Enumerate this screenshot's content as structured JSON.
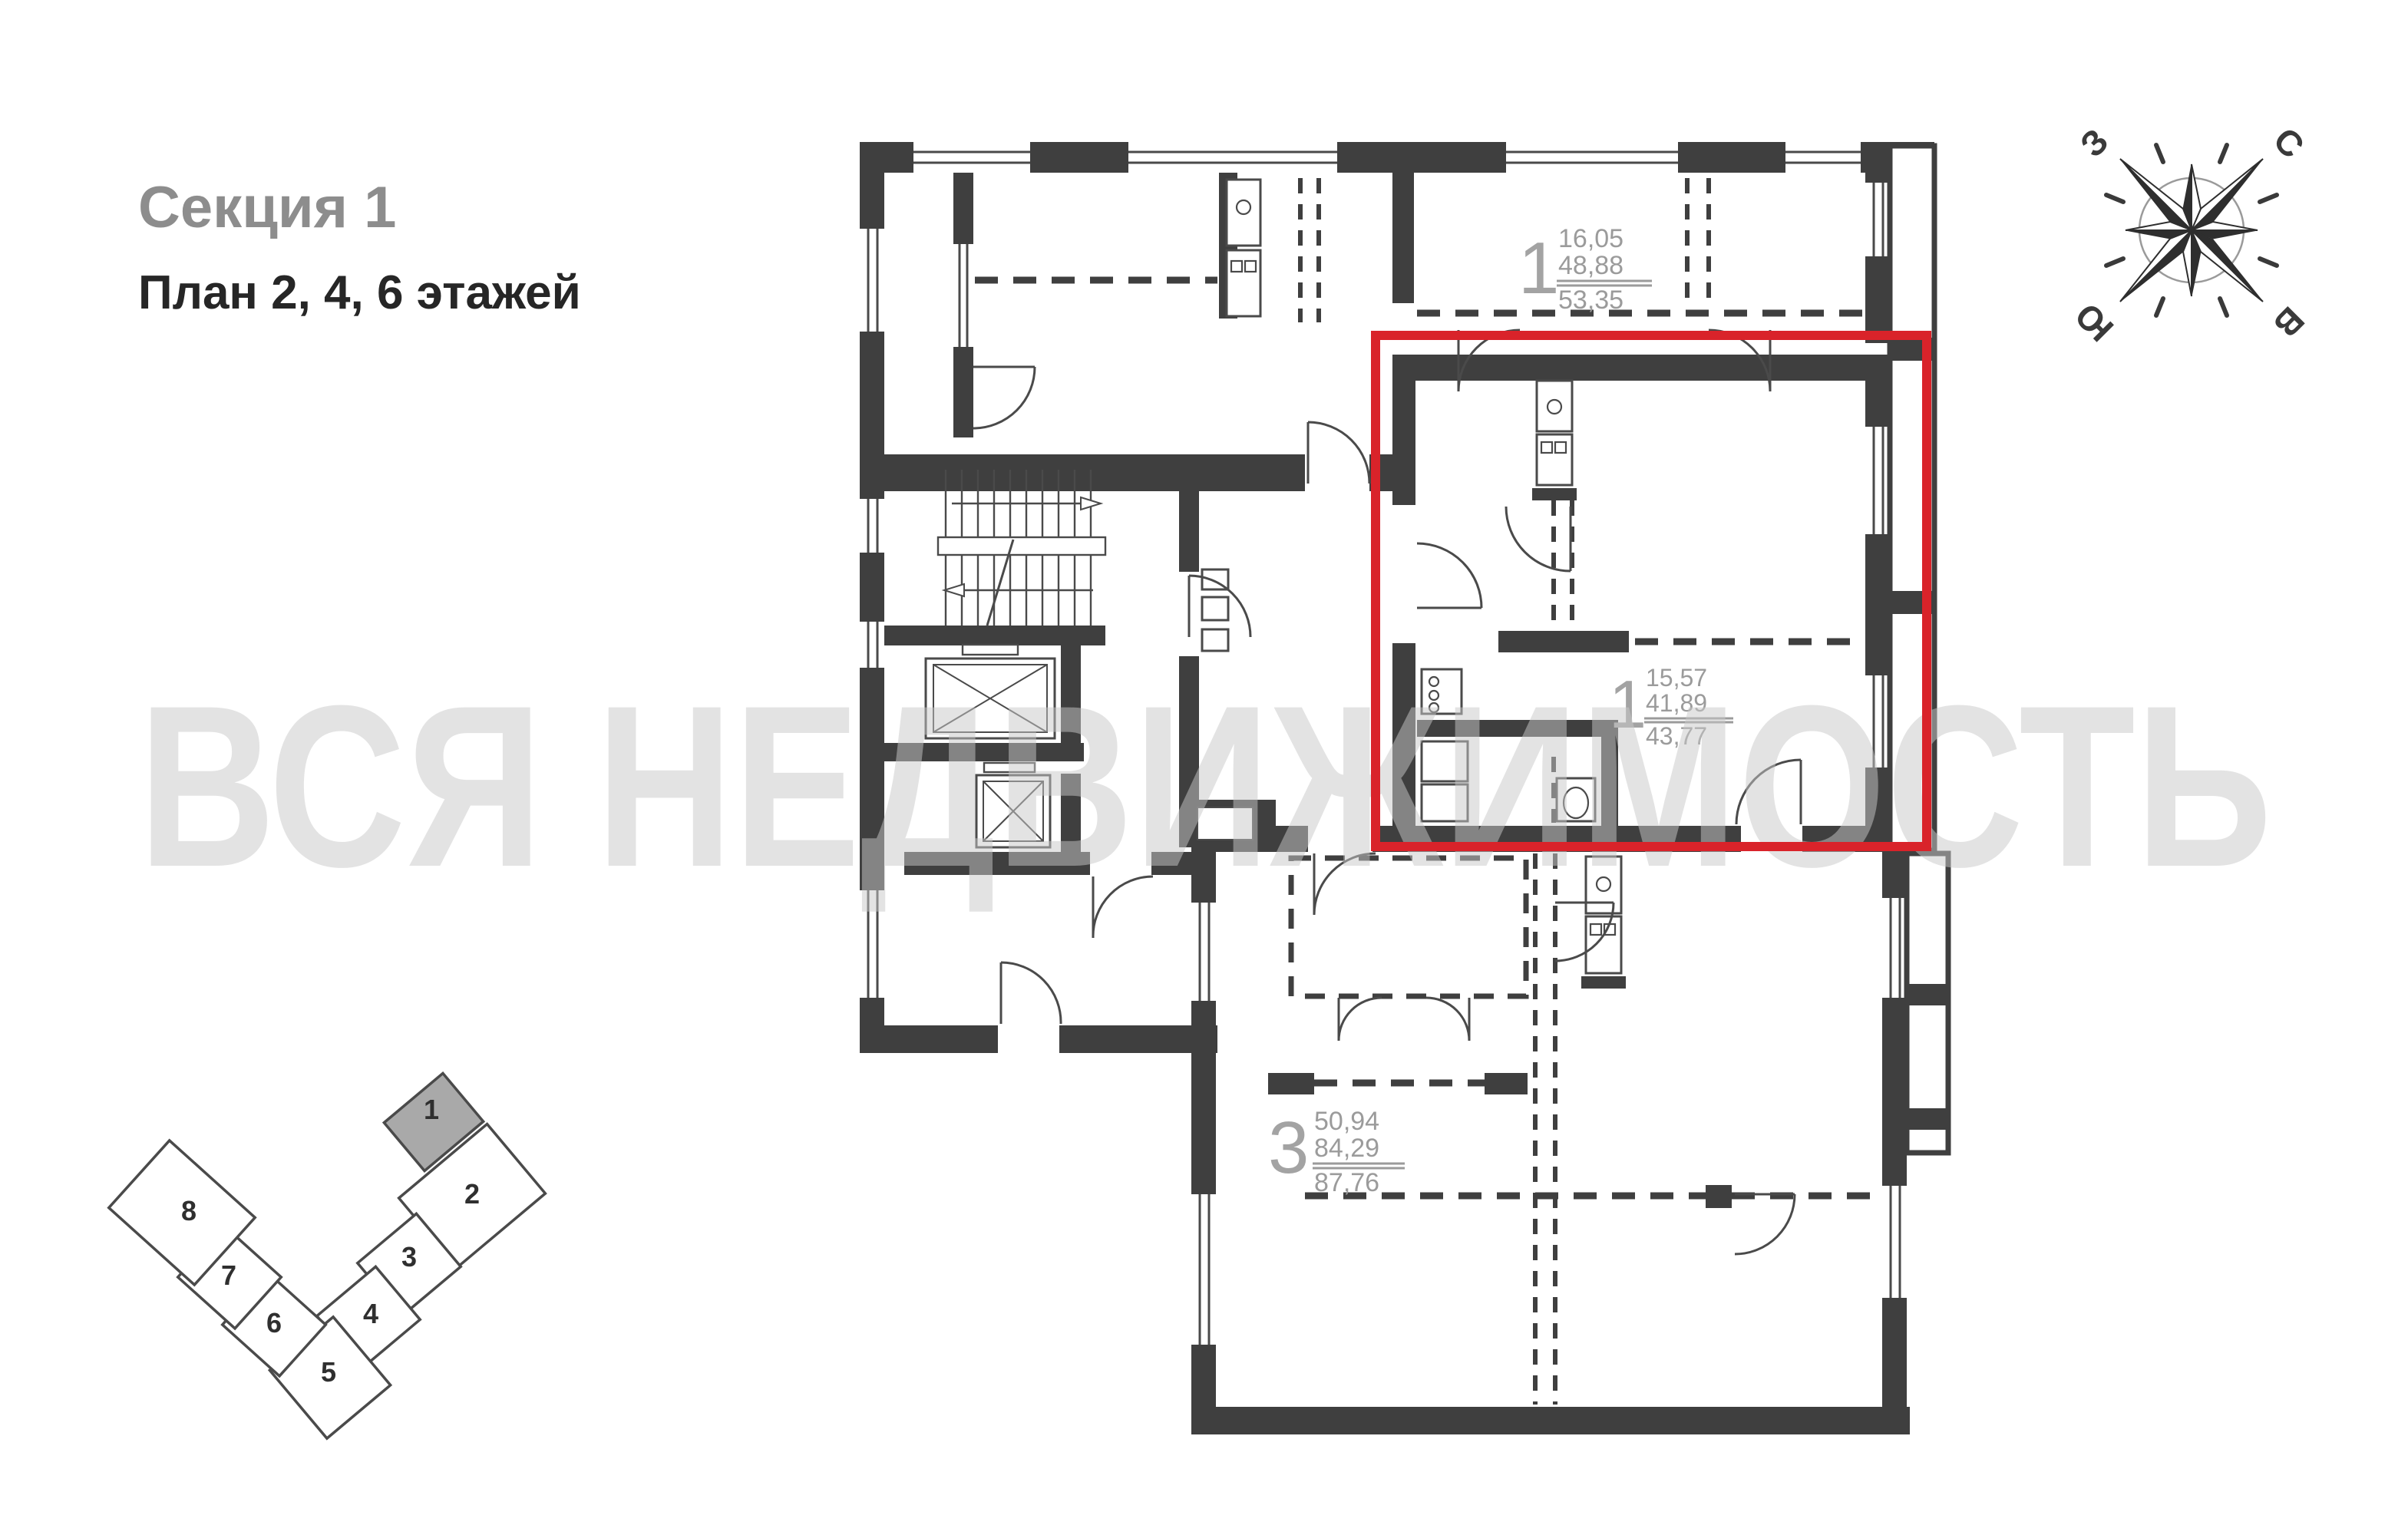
{
  "header": {
    "section_title": "Секция 1",
    "plan_subtitle": "План 2, 4, 6 этажей"
  },
  "floor_plan": {
    "wall_color": "#3f3f3f",
    "highlight_color": "#d9232a",
    "apartments": [
      {
        "id": "apartment-top",
        "rooms": "1",
        "values": [
          "16,05",
          "48,88",
          "53,35"
        ],
        "highlighted": false
      },
      {
        "id": "apartment-highlighted",
        "rooms": "1",
        "values": [
          "15,57",
          "41,89",
          "43,77"
        ],
        "highlighted": true
      },
      {
        "id": "apartment-bottom",
        "rooms": "3",
        "values": [
          "50,94",
          "84,29",
          "87,76"
        ],
        "highlighted": false
      }
    ]
  },
  "compass": {
    "north": "С",
    "south": "Ю",
    "west": "З",
    "east": "В"
  },
  "watermark": {
    "text": "ВСЯ НЕДВИЖИМОСТЬ",
    "color": "#e2e2e2"
  },
  "minimap": {
    "selected_section": "1",
    "selected_fill": "#a9a9a9",
    "sections": [
      {
        "label": "1"
      },
      {
        "label": "2"
      },
      {
        "label": "3"
      },
      {
        "label": "4"
      },
      {
        "label": "5"
      },
      {
        "label": "6"
      },
      {
        "label": "7"
      },
      {
        "label": "8"
      }
    ]
  }
}
